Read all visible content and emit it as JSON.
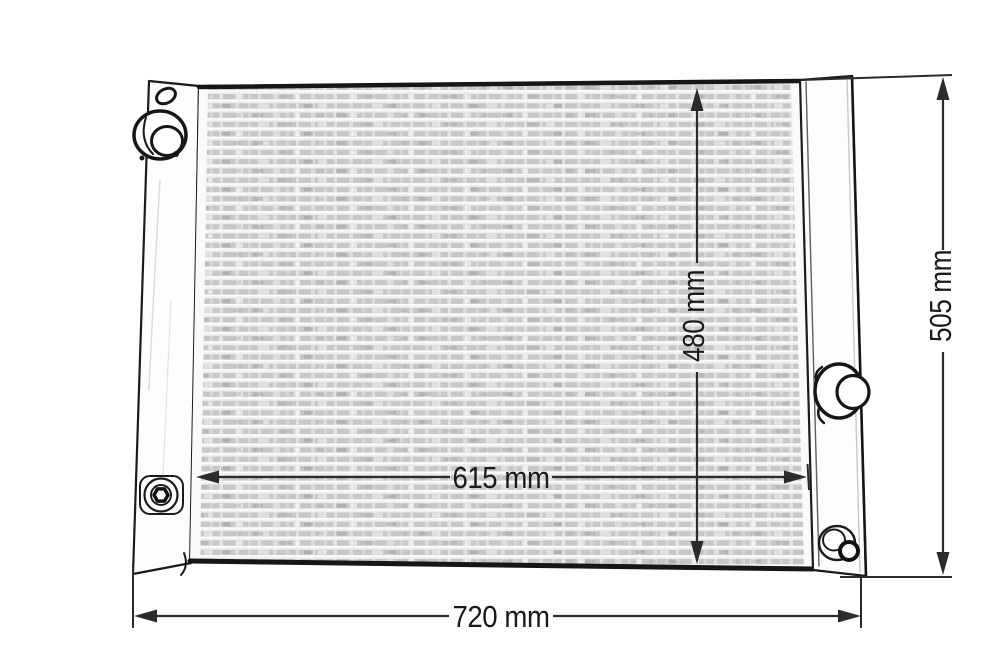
{
  "drawing": {
    "units": "mm",
    "labels": {
      "core_height": "480 mm",
      "overall_height": "505 mm",
      "core_width": "615 mm",
      "overall_width": "720 mm"
    },
    "values": {
      "core_height_mm": 480,
      "overall_height_mm": 505,
      "core_width_mm": 615,
      "overall_width_mm": 720
    },
    "colors": {
      "background": "#ffffff",
      "outline": "#1b1b1b",
      "dimension_line": "#2b2b2b",
      "fin_gray": "#c7c7c7"
    }
  }
}
